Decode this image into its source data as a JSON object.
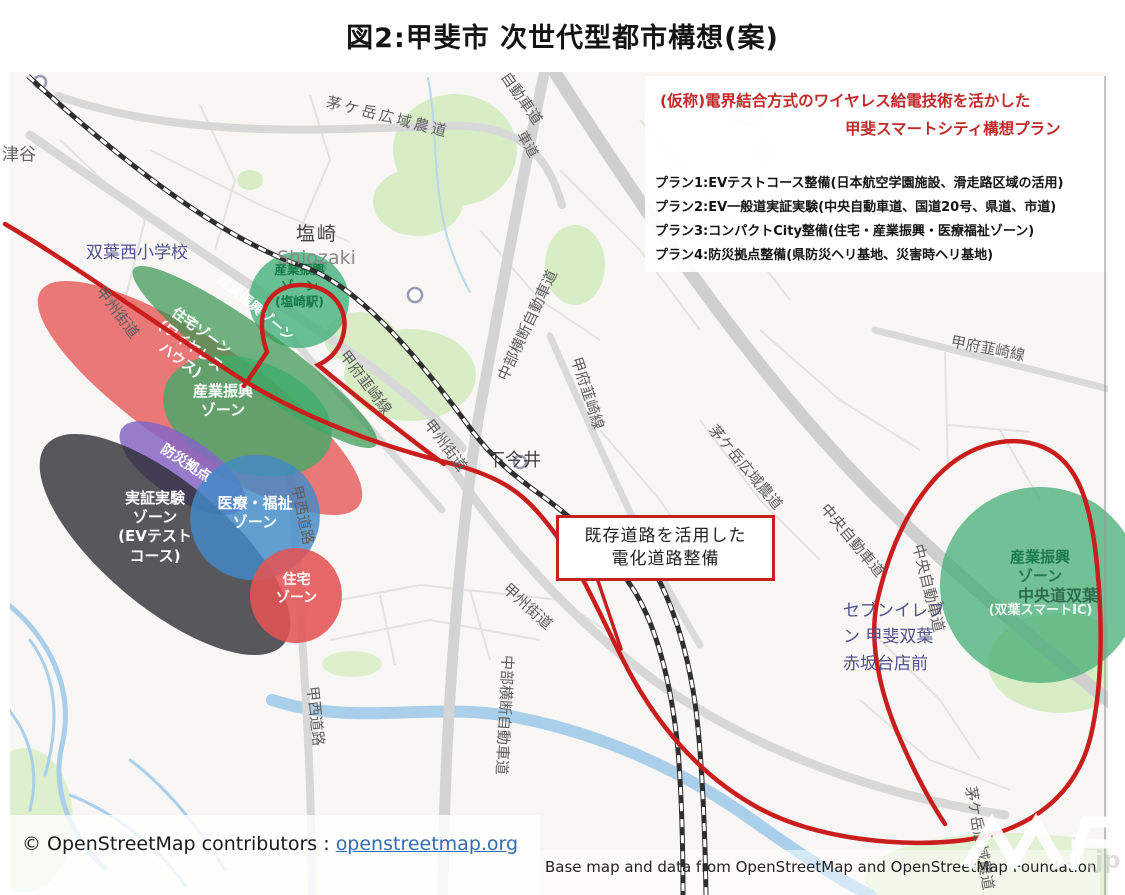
{
  "page_title": "図2:甲斐市 次世代型都市構想(案)",
  "legend": {
    "heading1": "(仮称)電界結合方式のワイヤレス給電技術を活かした",
    "heading2": "甲斐スマートシティ構想プラン",
    "plan1": "プラン1:EVテストコース整備(日本航空学園施設、滑走路区域の活用)",
    "plan2": "プラン2:EV一般道実証実験(中央自動車道、国道20号、県道、市道)",
    "plan3": "プラン3:コンパクトCity整備(住宅・産業振興・医療福祉ゾーン)",
    "plan4": "プラン4:防災拠点整備(県防災ヘリ基地、災害時ヘリ基地)"
  },
  "callout": {
    "text": "既存道路を活用した\n電化道路整備"
  },
  "zones": {
    "shiozaki": {
      "text": "産業振興\nゾーン\n(塩崎駅)"
    },
    "jutaku_wireless": {
      "text": "住宅ゾーン\n(ワイヤレス\nハウス)"
    },
    "sangyo_band": {
      "text": "産業振興ゾーン"
    },
    "sangyo_blob": {
      "text": "産業振興\nゾーン"
    },
    "bousai": {
      "text": "防災拠点"
    },
    "jisshou": {
      "text": "実証実験\nゾーン\n(EVテスト\nコース)"
    },
    "iryo": {
      "text": "医療・福祉\nゾーン"
    },
    "jutaku_south": {
      "text": "住宅\nゾーン"
    },
    "futaba_main": {
      "text": "産業振興\nゾーン"
    },
    "futaba_sub": {
      "text": "(双葉スマートIC)"
    }
  },
  "map_labels": {
    "tsuya": "津谷",
    "futaba_nishi_es": "双葉西小学校",
    "shiozaki_kanji": "塩崎",
    "shiozaki_romaji": "Shiozaki",
    "koshu_kaido": "甲州街道",
    "kayagatake": "茅ケ岳広域農道",
    "chubu_oudan": "中部横断自動車道",
    "kofu_nirasaki": "甲府韮崎線",
    "shimo_imai": "下今井",
    "chuo_expwy": "中央自動車道",
    "chuodo_futaba": "中央道双葉",
    "seven_eleven": "セブンイレブ\nン 甲斐双葉\n赤坂台店前",
    "kosai_road": "甲西道路",
    "partial_jidoshado": "自動車道",
    "partial_shado": "車道"
  },
  "attribution": {
    "osm_text": "© OpenStreetMap contributors :",
    "osm_link": "openstreetmap.org",
    "base_map": "Base map and data from OpenStreetMap and OpenStreetMap Foundation",
    "watermark_suffix": ".jp"
  },
  "colors": {
    "route_red": "#c81e1e",
    "zone_green": "#3cab73",
    "zone_red": "#e25555",
    "zone_purple": "#8a6cc8",
    "zone_blue": "#3f87c5",
    "zone_dark": "#37373c",
    "callout_border": "#c32222",
    "link_blue": "#2f6cb5"
  }
}
